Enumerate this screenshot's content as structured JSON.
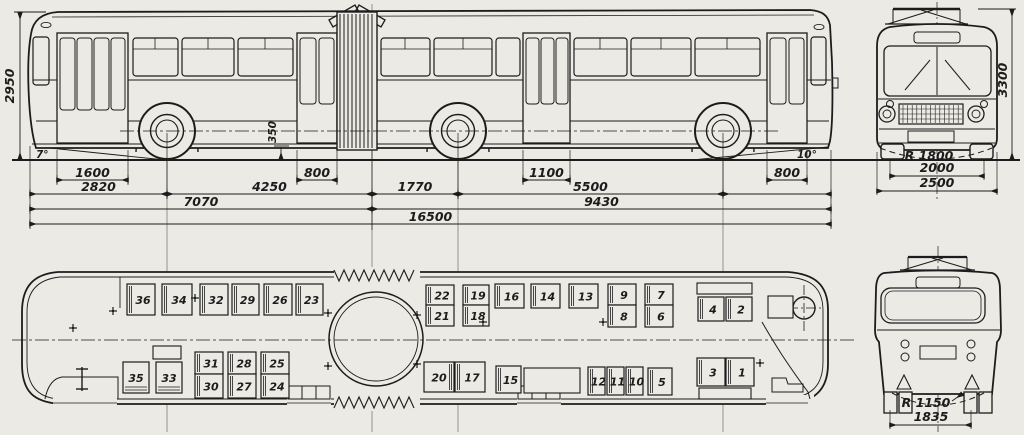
{
  "colors": {
    "paper": "#ECEAE5",
    "ink": "#1c1c1c",
    "faint": "#555555"
  },
  "side_view": {
    "height": "2950",
    "step_height": "350",
    "angle_left": "7°",
    "angle_right": "10°",
    "dim_rows": [
      {
        "y": 180,
        "dims": [
          {
            "label": "1600",
            "x1": 57,
            "x2": 128
          },
          {
            "label": "800",
            "x1": 297,
            "x2": 337
          },
          {
            "label": "1100",
            "x1": 523,
            "x2": 570
          },
          {
            "label": "800",
            "x1": 767,
            "x2": 807
          }
        ]
      },
      {
        "y": 194,
        "dims": [
          {
            "label": "2820",
            "x1": 30,
            "x2": 167
          },
          {
            "label": "4250",
            "x1": 167,
            "x2": 372
          },
          {
            "label": "1770",
            "x1": 372,
            "x2": 458
          },
          {
            "label": "5500",
            "x1": 458,
            "x2": 723
          },
          {
            "label": "",
            "x1": 723,
            "x2": 831
          }
        ]
      },
      {
        "y": 209,
        "dims": [
          {
            "label": "7070",
            "x1": 30,
            "x2": 372
          },
          {
            "label": "9430",
            "x1": 372,
            "x2": 831
          }
        ]
      },
      {
        "y": 224,
        "dims": [
          {
            "label": "16500",
            "x1": 30,
            "x2": 831
          }
        ]
      }
    ],
    "ext_lines": [
      [
        30,
        146,
        228
      ],
      [
        831,
        150,
        228
      ],
      [
        57,
        150,
        184
      ],
      [
        128,
        150,
        184
      ],
      [
        297,
        150,
        184
      ],
      [
        337,
        150,
        184
      ],
      [
        523,
        150,
        184
      ],
      [
        570,
        150,
        184
      ],
      [
        767,
        150,
        184
      ],
      [
        807,
        150,
        184
      ],
      [
        167,
        133,
        199
      ],
      [
        458,
        133,
        199
      ],
      [
        723,
        133,
        199
      ],
      [
        372,
        150,
        230
      ]
    ],
    "construction_lines": [
      [
        167,
        125,
        432
      ],
      [
        372,
        4,
        432
      ],
      [
        458,
        125,
        432
      ],
      [
        723,
        125,
        432
      ]
    ]
  },
  "front_view": {
    "height": "3300",
    "turn_radius": "R 1800",
    "track": "2000",
    "width": "2500"
  },
  "rear_view": {
    "turn_radius": "R 1150",
    "track": "1835"
  },
  "plan_view": {
    "seats": [
      {
        "n": "36",
        "x": 127,
        "y": 284,
        "w": 28,
        "h": 31,
        "band": "l"
      },
      {
        "n": "34",
        "x": 162,
        "y": 284,
        "w": 30,
        "h": 31,
        "band": "l"
      },
      {
        "n": "32",
        "x": 200,
        "y": 284,
        "w": 28,
        "h": 31,
        "band": "l"
      },
      {
        "n": "29",
        "x": 232,
        "y": 284,
        "w": 27,
        "h": 31,
        "band": "l"
      },
      {
        "n": "26",
        "x": 264,
        "y": 284,
        "w": 28,
        "h": 31,
        "band": "l"
      },
      {
        "n": "23",
        "x": 296,
        "y": 284,
        "w": 27,
        "h": 31,
        "band": "l"
      },
      {
        "n": "22",
        "x": 426,
        "y": 285,
        "w": 28,
        "h": 20,
        "band": "l"
      },
      {
        "n": "21",
        "x": 426,
        "y": 305,
        "w": 28,
        "h": 21,
        "band": "l"
      },
      {
        "n": "19",
        "x": 463,
        "y": 285,
        "w": 26,
        "h": 20,
        "band": "l"
      },
      {
        "n": "18",
        "x": 463,
        "y": 305,
        "w": 26,
        "h": 21,
        "band": "l"
      },
      {
        "n": "16",
        "x": 495,
        "y": 284,
        "w": 29,
        "h": 24,
        "band": "l"
      },
      {
        "n": "14",
        "x": 531,
        "y": 284,
        "w": 29,
        "h": 24,
        "band": "l"
      },
      {
        "n": "13",
        "x": 569,
        "y": 284,
        "w": 29,
        "h": 24,
        "band": "l"
      },
      {
        "n": "9",
        "x": 608,
        "y": 284,
        "w": 28,
        "h": 21,
        "band": "l"
      },
      {
        "n": "8",
        "x": 608,
        "y": 305,
        "w": 28,
        "h": 22,
        "band": "l"
      },
      {
        "n": "7",
        "x": 645,
        "y": 284,
        "w": 28,
        "h": 21,
        "band": "l"
      },
      {
        "n": "6",
        "x": 645,
        "y": 305,
        "w": 28,
        "h": 22,
        "band": "l"
      },
      {
        "n": "4",
        "x": 698,
        "y": 297,
        "w": 26,
        "h": 24,
        "band": "l"
      },
      {
        "n": "2",
        "x": 726,
        "y": 297,
        "w": 26,
        "h": 24,
        "band": "l"
      },
      {
        "n": "35",
        "x": 123,
        "y": 362,
        "w": 26,
        "h": 31,
        "band": "b"
      },
      {
        "n": "33",
        "x": 156,
        "y": 362,
        "w": 26,
        "h": 31,
        "band": "b"
      },
      {
        "n": "31",
        "x": 195,
        "y": 352,
        "w": 28,
        "h": 22,
        "band": "l"
      },
      {
        "n": "30",
        "x": 195,
        "y": 374,
        "w": 28,
        "h": 24,
        "band": "l"
      },
      {
        "n": "28",
        "x": 228,
        "y": 352,
        "w": 28,
        "h": 22,
        "band": "l"
      },
      {
        "n": "27",
        "x": 228,
        "y": 374,
        "w": 28,
        "h": 24,
        "band": "l"
      },
      {
        "n": "25",
        "x": 261,
        "y": 352,
        "w": 28,
        "h": 22,
        "band": "l"
      },
      {
        "n": "24",
        "x": 261,
        "y": 374,
        "w": 28,
        "h": 24,
        "band": "l"
      },
      {
        "n": "20",
        "x": 424,
        "y": 362,
        "w": 30,
        "h": 30,
        "band": "r"
      },
      {
        "n": "17",
        "x": 455,
        "y": 362,
        "w": 30,
        "h": 30,
        "band": "l"
      },
      {
        "n": "15",
        "x": 496,
        "y": 366,
        "w": 25,
        "h": 27,
        "band": "l"
      },
      {
        "n": "12",
        "x": 588,
        "y": 367,
        "w": 17,
        "h": 28,
        "band": "l"
      },
      {
        "n": "11",
        "x": 607,
        "y": 367,
        "w": 17,
        "h": 28,
        "band": "l"
      },
      {
        "n": "10",
        "x": 626,
        "y": 367,
        "w": 17,
        "h": 28,
        "band": "l"
      },
      {
        "n": "5",
        "x": 648,
        "y": 368,
        "w": 24,
        "h": 27,
        "band": "l"
      },
      {
        "n": "3",
        "x": 697,
        "y": 358,
        "w": 28,
        "h": 28,
        "band": "l"
      },
      {
        "n": "1",
        "x": 726,
        "y": 358,
        "w": 28,
        "h": 28,
        "band": "l"
      }
    ],
    "benches": [
      {
        "x": 697,
        "y": 283,
        "w": 55,
        "h": 11
      },
      {
        "x": 524,
        "y": 368,
        "w": 56,
        "h": 25
      },
      {
        "x": 699,
        "y": 388,
        "w": 52,
        "h": 11
      },
      {
        "x": 768,
        "y": 296,
        "w": 25,
        "h": 22
      }
    ],
    "heaters": [
      {
        "x": 153,
        "y": 346,
        "w": 28,
        "h": 13
      }
    ],
    "crosses": [
      [
        73,
        328
      ],
      [
        113,
        311
      ],
      [
        195,
        298
      ],
      [
        328,
        313
      ],
      [
        328,
        366
      ],
      [
        417,
        315
      ],
      [
        417,
        364
      ],
      [
        483,
        322
      ],
      [
        603,
        322
      ],
      [
        760,
        363
      ]
    ],
    "steering_wheel": {
      "cx": 804,
      "cy": 308,
      "r": 11
    }
  }
}
